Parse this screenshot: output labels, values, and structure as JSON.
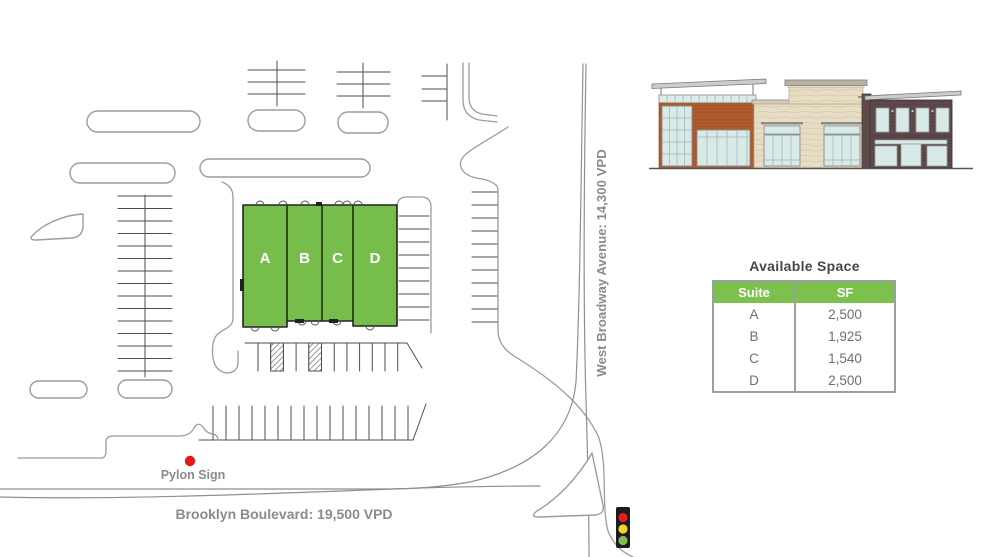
{
  "colors": {
    "building_green": "#76bd4b",
    "table_header_green": "#7cc14e",
    "pylon_dot_red": "#e41a1a",
    "traffic_light_red": "#e02020",
    "traffic_light_yellow": "#f0d32b",
    "traffic_light_green": "#7fbf4e"
  },
  "site_plan": {
    "building": {
      "suites": [
        {
          "id": "A"
        },
        {
          "id": "B"
        },
        {
          "id": "C"
        },
        {
          "id": "D"
        }
      ]
    },
    "labels": {
      "west_broadway": "West Broadway Avenue: 14,300 VPD",
      "brooklyn_blvd": "Brooklyn Boulevard: 19,500 VPD",
      "pylon_sign": "Pylon Sign"
    }
  },
  "panel": {
    "available_space": {
      "title": "Available Space",
      "columns": [
        "Suite",
        "SF"
      ],
      "rows": [
        {
          "suite": "A",
          "sf": "2,500"
        },
        {
          "suite": "B",
          "sf": "1,925"
        },
        {
          "suite": "C",
          "sf": "1,540"
        },
        {
          "suite": "D",
          "sf": "2,500"
        }
      ]
    }
  }
}
